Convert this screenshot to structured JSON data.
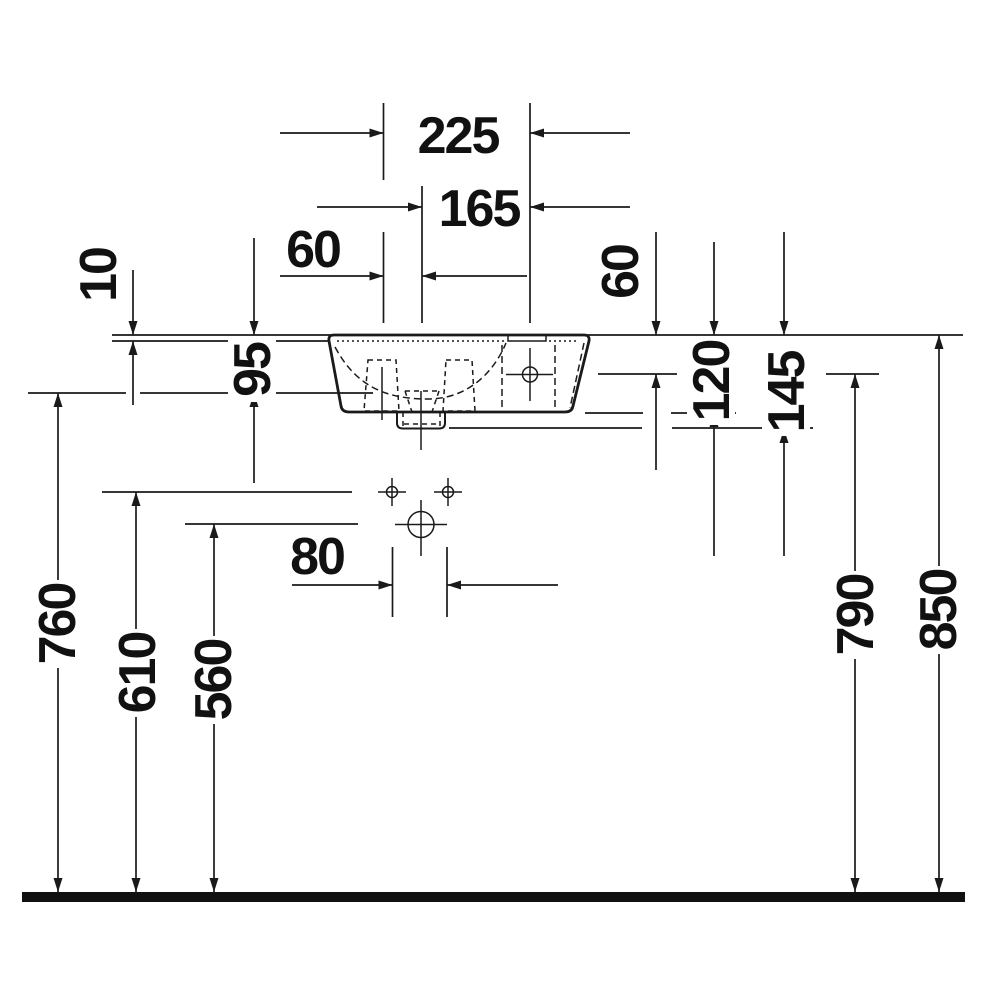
{
  "drawing": {
    "kind": "sanitary-ware installation dimension drawing, side view",
    "colors": {
      "ink": "#1a1a1a",
      "paper": "#ffffff"
    }
  },
  "labels": {
    "d225": "225",
    "d165": "165",
    "d60_left": "60",
    "d60_right": "60",
    "d10": "10",
    "d95": "95",
    "d120": "120",
    "d145": "145",
    "d80": "80",
    "d760": "760",
    "d610": "610",
    "d560": "560",
    "d790": "790",
    "d850": "850"
  }
}
